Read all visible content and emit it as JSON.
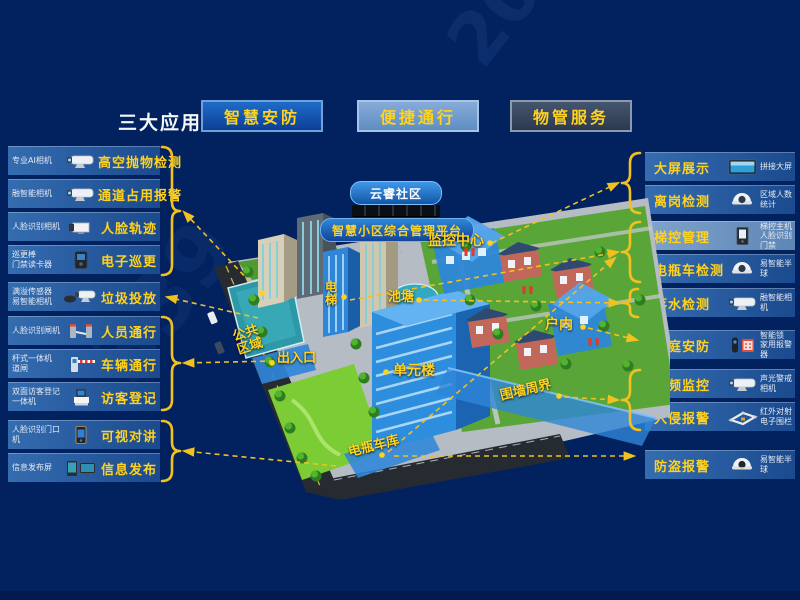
{
  "header": {
    "title": "三大应用",
    "apps": [
      {
        "label": "智慧安防"
      },
      {
        "label": "便捷通行"
      },
      {
        "label": "物管服务"
      }
    ]
  },
  "left_panel": [
    {
      "device": "专业AI相机",
      "label": "高空抛物检测",
      "icon": "bullet-camera"
    },
    {
      "device": "融智能相机",
      "label": "通道占用报警",
      "icon": "bullet-camera"
    },
    {
      "device": "人脸识别相机",
      "label": "人脸轨迹",
      "icon": "box-camera"
    },
    {
      "device": "巡更棒\n门禁读卡器",
      "label": "电子巡更",
      "icon": "card-reader"
    },
    {
      "device": "满溢传感器\n易智能相机",
      "label": "垃圾投放",
      "icon": "overflow-sensor-camera"
    },
    {
      "device": "人脸识别闸机",
      "label": "人员通行",
      "icon": "turnstile"
    },
    {
      "device": "杆式一体机\n道闸",
      "label": "车辆通行",
      "icon": "barrier-gate"
    },
    {
      "device": "双面访客登记\n一体机",
      "label": "访客登记",
      "icon": "visitor-kiosk"
    },
    {
      "device": "人脸识别门口机",
      "label": "可视对讲",
      "icon": "door-intercom"
    },
    {
      "device": "信息发布屏",
      "label": "信息发布",
      "icon": "info-screen"
    }
  ],
  "right_panel": [
    {
      "label": "大屏展示",
      "device": "拼接大屏",
      "icon": "video-wall"
    },
    {
      "label": "离岗检测",
      "device": "区域人数统计",
      "icon": "dome-camera"
    },
    {
      "label": "梯控管理",
      "device": "梯控主机\n人脸识别门禁",
      "icon": "elevator-controller"
    },
    {
      "label": "电瓶车检测",
      "device": "易智能半球",
      "icon": "dome-camera"
    },
    {
      "label": "落水检测",
      "device": "融智能相机",
      "icon": "bullet-camera"
    },
    {
      "label": "家庭安防",
      "device": "智能锁\n家用报警器",
      "icon": "smart-lock-siren"
    },
    {
      "label": "视频监控",
      "device": "声光警戒相机",
      "icon": "bullet-camera"
    },
    {
      "label": "入侵报警",
      "device": "红外对射\n电子围栏",
      "icon": "fence"
    },
    {
      "label": "防盗报警",
      "device": "易智能半球",
      "icon": "dome-camera"
    }
  ],
  "map": {
    "cloud_label": "云睿社区",
    "platform_label": "智慧小区综合管理平台",
    "zones": [
      {
        "label": "监控中心"
      },
      {
        "label": "电梯"
      },
      {
        "label": "池塘"
      },
      {
        "label": "公共区域"
      },
      {
        "label": "出入口"
      },
      {
        "label": "单元楼"
      },
      {
        "label": "户内"
      },
      {
        "label": "围墙周界"
      },
      {
        "label": "电瓶车库"
      }
    ]
  },
  "watermarks": {
    "w1": "2020-09",
    "w2": "339"
  },
  "colors": {
    "background": "#01215f",
    "accent_yellow": "#ffd21f",
    "row_blue": "#2a5ba3",
    "highlight_blue": "#2f86d8"
  }
}
